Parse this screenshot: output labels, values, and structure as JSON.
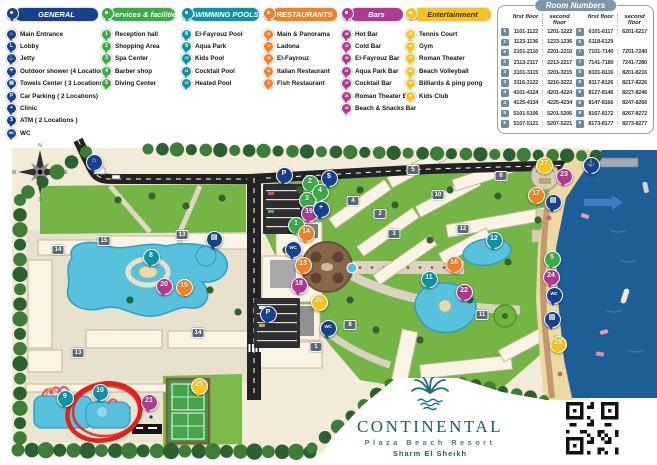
{
  "legend": {
    "categories": [
      {
        "name": "general",
        "label": "GENERAL",
        "color": "#16418e",
        "items": [
          {
            "icon": "main-entrance-icon",
            "glyph": "⌂",
            "label": "Main Entrance"
          },
          {
            "icon": "lobby-icon",
            "glyph": "L",
            "label": "Lobby"
          },
          {
            "icon": "jetty-icon",
            "glyph": "⚓",
            "label": "Jetty"
          },
          {
            "icon": "outdoor-shower-icon",
            "glyph": "☂",
            "label": "Outdoor shower (4 Locations)"
          },
          {
            "icon": "towels-center-icon",
            "glyph": "▤",
            "label": "Towels Center ( 3 Locations)"
          },
          {
            "icon": "car-parking-icon",
            "glyph": "P",
            "label": "Car Parking ( 2 Locations)"
          },
          {
            "icon": "clinic-icon",
            "glyph": "+",
            "label": "Clinic"
          },
          {
            "icon": "atm-icon",
            "glyph": "$",
            "label": "ATM ( 2 Locations )"
          },
          {
            "icon": "wc-icon",
            "glyph": "WC",
            "label": "WC"
          }
        ]
      },
      {
        "name": "services",
        "label": "Services & facilities",
        "color": "#3aab47",
        "items": [
          {
            "num": "1",
            "label": "Reception hall"
          },
          {
            "num": "2",
            "label": "Shopping Area"
          },
          {
            "num": "3",
            "label": "Spa Center"
          },
          {
            "num": "4",
            "label": "Barber shop"
          },
          {
            "num": "5",
            "label": "Diving Center"
          }
        ]
      },
      {
        "name": "pools",
        "label": "SWIMMING POOLS",
        "color": "#0e93a5",
        "items": [
          {
            "num": "8",
            "label": "El-Fayrouz Pool"
          },
          {
            "num": "9",
            "label": "Aqua Park"
          },
          {
            "num": "10",
            "label": "Kids Pool"
          },
          {
            "num": "11",
            "label": "Cocktail Pool"
          },
          {
            "num": "12",
            "label": "Heated Pool"
          }
        ]
      },
      {
        "name": "restaurants",
        "label": "RESTAURANTS",
        "color": "#f28024",
        "items": [
          {
            "num": "13",
            "label": "Main & Panorama"
          },
          {
            "num": "14",
            "label": "Ladona"
          },
          {
            "num": "15",
            "label": "El-Fayrouz"
          },
          {
            "num": "16",
            "label": "Italian Restaurant"
          },
          {
            "num": "17",
            "label": "Fish Restaurant"
          }
        ]
      },
      {
        "name": "bars",
        "label": "Bars",
        "color": "#b03a92",
        "items": [
          {
            "num": "18",
            "label": "Hot Bar"
          },
          {
            "num": "19",
            "label": "Cold Bar"
          },
          {
            "num": "20",
            "label": "El-Fayrouz Bar"
          },
          {
            "num": "21",
            "label": "Aqua Park Bar"
          },
          {
            "num": "22",
            "label": "Cocktail Bar"
          },
          {
            "num": "23",
            "label": "Roman Theater Bar"
          },
          {
            "num": "24",
            "label": "Beach & Snacks Bar"
          }
        ]
      },
      {
        "name": "entertainment",
        "label": "Entertainment",
        "color": "#f6c51d",
        "text": "#3a3000",
        "items": [
          {
            "num": "25",
            "label": "Tennis Court"
          },
          {
            "num": "26",
            "label": "Gym"
          },
          {
            "num": "27",
            "label": "Roman Theater"
          },
          {
            "num": "28",
            "label": "Beach Volleyball"
          },
          {
            "num": "29",
            "label": "Billiards & ping pong"
          },
          {
            "num": "30",
            "label": "Kids Club"
          }
        ]
      }
    ]
  },
  "room_table": {
    "title": "Room Numbers",
    "headers": [
      "first floor",
      "second floor",
      "first floor",
      "second floor"
    ],
    "left_rows": [
      [
        "1",
        "1101-1122",
        "1201-1222"
      ],
      [
        "1",
        "1123-1136",
        "1223-1236"
      ],
      [
        "2",
        "2101-2110",
        "2201-2210"
      ],
      [
        "2",
        "2113-2117",
        "2213-2217"
      ],
      [
        "3",
        "3101-3115",
        "3201-3215"
      ],
      [
        "3",
        "3116-3122",
        "3216-3222"
      ],
      [
        "4",
        "4101-4124",
        "4201-4224"
      ],
      [
        "4",
        "4125-4134",
        "4225-4234"
      ],
      [
        "5",
        "5101-5106",
        "5201-5206"
      ],
      [
        "5",
        "5107-5121",
        "5207-5221"
      ]
    ],
    "right_rows": [
      [
        "6",
        "6101-6117",
        "6201-6217"
      ],
      [
        "6",
        "6118-6129",
        ""
      ],
      [
        "7",
        "7101-7140",
        "7201-7240"
      ],
      [
        "7",
        "7141-7180",
        "7241-7280"
      ],
      [
        "8",
        "8101-8116",
        "8201-8216"
      ],
      [
        "8",
        "8117-8126",
        "8217-8226"
      ],
      [
        "8",
        "8127-8146",
        "8227-8246"
      ],
      [
        "8",
        "8147-8166",
        "8247-8266"
      ],
      [
        "8",
        "8167-8172",
        "8267-8272"
      ],
      [
        "8",
        "8173-8177",
        "8273-8277"
      ]
    ]
  },
  "logo": {
    "name": "CONTINENTAL",
    "subtitle": "Plaza Beach Resort",
    "location": "Sharm El Sheikh"
  },
  "map": {
    "colors": {
      "general": "#16418e",
      "services": "#3aab47",
      "pools": "#0e93a5",
      "restaurants": "#f28024",
      "bars": "#b03a92",
      "entertainment": "#f6c51d",
      "annotation": "#e32119"
    },
    "pins": [
      {
        "n": "1",
        "cat": "services",
        "x": 295,
        "y": 236
      },
      {
        "n": "2",
        "cat": "services",
        "x": 309,
        "y": 194
      },
      {
        "n": "3",
        "cat": "services",
        "x": 306,
        "y": 211
      },
      {
        "n": "4",
        "cat": "services",
        "x": 319,
        "y": 203
      },
      {
        "n": "5",
        "cat": "services",
        "x": 551,
        "y": 270
      },
      {
        "n": "8",
        "cat": "pools",
        "x": 150,
        "y": 268
      },
      {
        "n": "9",
        "cat": "pools",
        "x": 64,
        "y": 409
      },
      {
        "n": "10",
        "cat": "pools",
        "x": 99,
        "y": 403
      },
      {
        "n": "11",
        "cat": "pools",
        "x": 428,
        "y": 290
      },
      {
        "n": "12",
        "cat": "pools",
        "x": 493,
        "y": 251
      },
      {
        "n": "13",
        "cat": "restaurants",
        "x": 302,
        "y": 276
      },
      {
        "n": "14",
        "cat": "restaurants",
        "x": 305,
        "y": 244
      },
      {
        "n": "15",
        "cat": "restaurants",
        "x": 183,
        "y": 298
      },
      {
        "n": "16",
        "cat": "restaurants",
        "x": 453,
        "y": 275
      },
      {
        "n": "17",
        "cat": "restaurants",
        "x": 535,
        "y": 206
      },
      {
        "n": "18",
        "cat": "bars",
        "x": 298,
        "y": 296
      },
      {
        "n": "19",
        "cat": "bars",
        "x": 308,
        "y": 224
      },
      {
        "n": "20",
        "cat": "bars",
        "x": 163,
        "y": 297
      },
      {
        "n": "21",
        "cat": "bars",
        "x": 148,
        "y": 413
      },
      {
        "n": "22",
        "cat": "bars",
        "x": 463,
        "y": 303
      },
      {
        "n": "23",
        "cat": "bars",
        "x": 563,
        "y": 187
      },
      {
        "n": "24",
        "cat": "bars",
        "x": 550,
        "y": 288
      },
      {
        "n": "25",
        "cat": "entertainment",
        "x": 198,
        "y": 397
      },
      {
        "n": "26",
        "cat": "entertainment",
        "x": 318,
        "y": 313
      },
      {
        "n": "27",
        "cat": "entertainment",
        "x": 543,
        "y": 176
      },
      {
        "n": "28",
        "cat": "entertainment",
        "x": 557,
        "y": 355
      }
    ],
    "icon_pins": [
      {
        "glyph": "⌂",
        "name": "main-entrance-pin",
        "x": 93,
        "y": 173
      },
      {
        "glyph": "P",
        "name": "parking-pin-north",
        "x": 283,
        "y": 186
      },
      {
        "glyph": "P",
        "name": "parking-pin-south",
        "x": 267,
        "y": 325
      },
      {
        "glyph": "$",
        "name": "atm-pin",
        "x": 328,
        "y": 189
      },
      {
        "glyph": "+",
        "name": "clinic-pin",
        "x": 320,
        "y": 220
      },
      {
        "glyph": "WC",
        "name": "wc-pin-center",
        "x": 292,
        "y": 260
      },
      {
        "glyph": "▤",
        "name": "towels-pin-pool",
        "x": 213,
        "y": 250
      },
      {
        "glyph": "WC",
        "name": "wc-pin-south",
        "x": 327,
        "y": 339
      },
      {
        "glyph": "▤",
        "name": "towels-pin-beach-north",
        "x": 552,
        "y": 213
      },
      {
        "glyph": "WC",
        "name": "wc-pin-beach",
        "x": 553,
        "y": 306
      },
      {
        "glyph": "▤",
        "name": "towels-pin-beach-south",
        "x": 551,
        "y": 330
      },
      {
        "glyph": "⚓",
        "name": "jetty-pin",
        "x": 590,
        "y": 176
      }
    ],
    "building_tags": [
      {
        "n": "14",
        "x": 58,
        "y": 250
      },
      {
        "n": "15",
        "x": 104,
        "y": 241
      },
      {
        "n": "13",
        "x": 182,
        "y": 235
      },
      {
        "n": "13",
        "x": 78,
        "y": 353
      },
      {
        "n": "14",
        "x": 198,
        "y": 333
      },
      {
        "n": "1",
        "x": 316,
        "y": 347
      },
      {
        "n": "8",
        "x": 350,
        "y": 325
      },
      {
        "n": "2",
        "x": 380,
        "y": 214
      },
      {
        "n": "3",
        "x": 394,
        "y": 234
      },
      {
        "n": "4",
        "x": 353,
        "y": 201
      },
      {
        "n": "5",
        "x": 413,
        "y": 170
      },
      {
        "n": "10",
        "x": 438,
        "y": 195
      },
      {
        "n": "6",
        "x": 501,
        "y": 176
      },
      {
        "n": "12",
        "x": 463,
        "y": 229
      },
      {
        "n": "11",
        "x": 482,
        "y": 315
      }
    ]
  }
}
